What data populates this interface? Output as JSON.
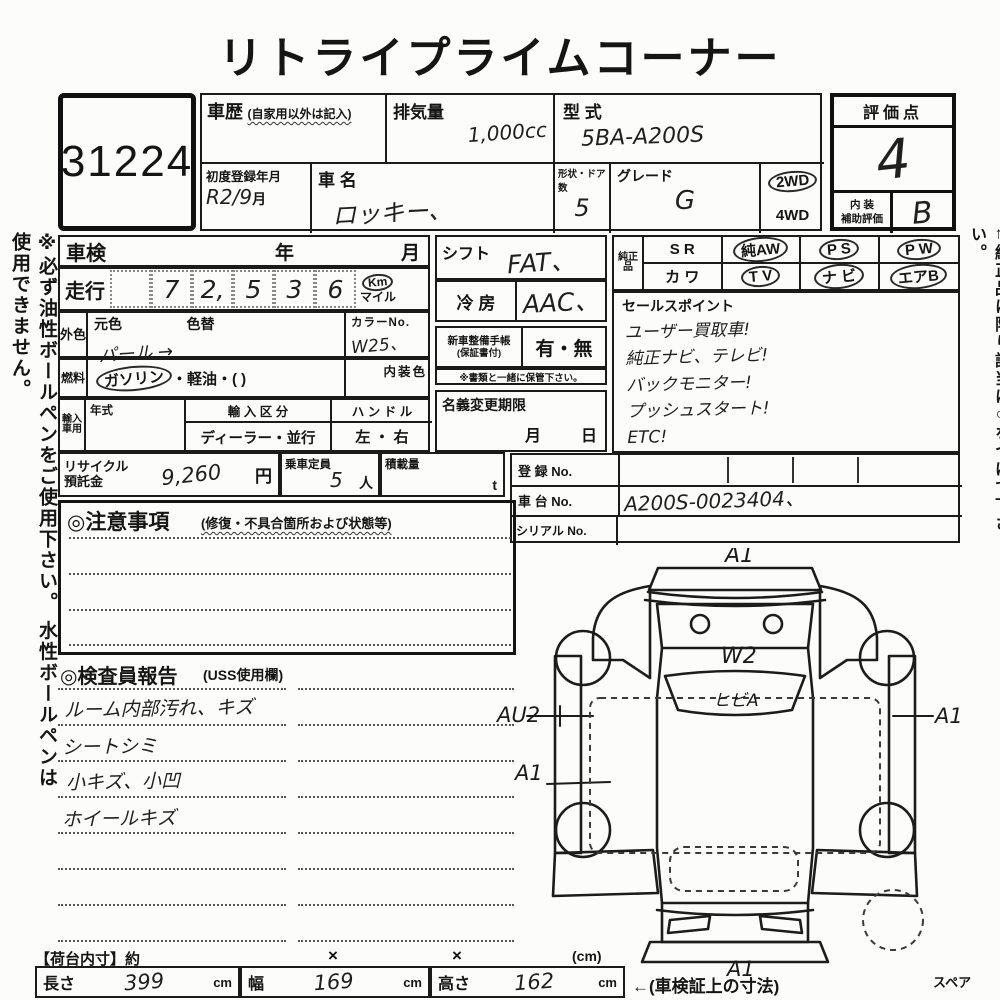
{
  "title": "リトライプライムコーナー",
  "side_notes": {
    "left": "※必ず油性ボールペンをご使用下さい。 水性ボールペンは使用できません。",
    "right": "←純正品に限り該当に○をつけて下さい。"
  },
  "lot_no": "31224",
  "header": {
    "history_label": "車歴",
    "history_note": "(自家用以外は記入)",
    "displacement_label": "排気量",
    "displacement_value": "1,000cc",
    "model_label": "型 式",
    "model_value": "5BA-A200S",
    "first_reg_label": "初度登録年月",
    "first_reg_value": "R2/9",
    "first_reg_suffix": "月",
    "name_label": "車 名",
    "name_value": "ロッキー、",
    "shape_label": "形状・ドア数",
    "shape_value": "5",
    "grade_label": "グレード",
    "grade_value": "G",
    "drive_2wd": "2WD",
    "drive_4wd": "4WD"
  },
  "rating": {
    "score_label": "評価点",
    "score_value": "4",
    "interior_label_top": "内 装",
    "interior_label_bottom": "補助評価",
    "interior_value": "B"
  },
  "left_table": {
    "shaken_label": "車検",
    "shaken_year": "年",
    "shaken_month": "月",
    "mileage_label": "走行",
    "mileage_digits": [
      "",
      "7",
      "2,",
      "5",
      "3",
      "6"
    ],
    "mileage_unit_km": "Km",
    "mileage_unit_mile": "マイル",
    "ext_label": "外色",
    "ext_orig_label": "元色",
    "ext_change_label": "色替",
    "ext_value": "パール →",
    "color_no_label": "カラーNo.",
    "color_no_value": "W25、",
    "fuel_label": "燃料",
    "fuel_gasoline": "ガソリン",
    "fuel_rest": "・軽油・(       )",
    "interior_color_label": "内装色",
    "import_label": "輸入車用",
    "import_year_label": "年式",
    "import_class_label": "輸 入 区 分",
    "import_class_value": "ディーラー・並行",
    "handle_label": "ハ ン ド ル",
    "handle_value": "左 ・ 右",
    "recycle_label_1": "リサイクル",
    "recycle_label_2": "預託金",
    "recycle_value": "9,260",
    "recycle_unit": "円",
    "capacity_label": "乗車定員",
    "capacity_value": "5",
    "capacity_unit": "人",
    "load_label": "積載量",
    "load_unit": "t"
  },
  "mid_table": {
    "shift_label": "シフト",
    "shift_value": "FAT、",
    "ac_label": "冷 房",
    "ac_value": "AAC、",
    "book_label": "新車整備手帳",
    "book_sublabel": "(保証書付)",
    "book_options": "有・無",
    "book_note": "※書類と一緒に保管下さい。",
    "transfer_label": "名義変更期限",
    "transfer_month": "月",
    "transfer_day": "日"
  },
  "genuine": {
    "label": "純正品",
    "cells": [
      {
        "text": "S R"
      },
      {
        "text": "純AW"
      },
      {
        "text": "P S"
      },
      {
        "text": "P W"
      },
      {
        "text": "カ ワ"
      },
      {
        "text": "T V"
      },
      {
        "text": "ナ ビ"
      },
      {
        "text": "エアB"
      }
    ]
  },
  "sales": {
    "label": "セールスポイント",
    "lines": [
      "ユーザー買取車!",
      "純正ナビ、テレビ!",
      "バックモニター!",
      "プッシュスタート!",
      "ETC!"
    ]
  },
  "registration": {
    "reg_label": "登 録 No.",
    "chassis_label": "車 台 No.",
    "chassis_value": "A200S-0023404、",
    "serial_label": "シリアル No."
  },
  "notes_box": {
    "title": "◎注意事項",
    "subtitle": "(修復・不具合箇所および状態等)"
  },
  "inspector": {
    "title": "◎検査員報告",
    "subtitle": "(USS使用欄)",
    "findings": [
      "ルーム内部汚れ、キズ",
      "シートシミ",
      "小キズ、小凹",
      "ホイールキズ"
    ]
  },
  "diagram": {
    "front_label": "A1",
    "hood_label": "W2",
    "windshield_label": "ヒビA",
    "left_front_label": "AU2",
    "right_label": "A1",
    "left_rear_label": "A1",
    "rear_label": "A1",
    "spare_label": "スペア"
  },
  "dimensions": {
    "cargo_label": "【荷台内寸】約",
    "x1": "×",
    "x2": "×",
    "unit_note": "(cm)",
    "length_label": "長さ",
    "length_value": "399",
    "length_unit": "cm",
    "width_label": "幅",
    "width_value": "169",
    "width_unit": "cm",
    "height_label": "高さ",
    "height_value": "162",
    "height_unit": "cm",
    "arrow_note": "←(車検証上の寸法)"
  }
}
